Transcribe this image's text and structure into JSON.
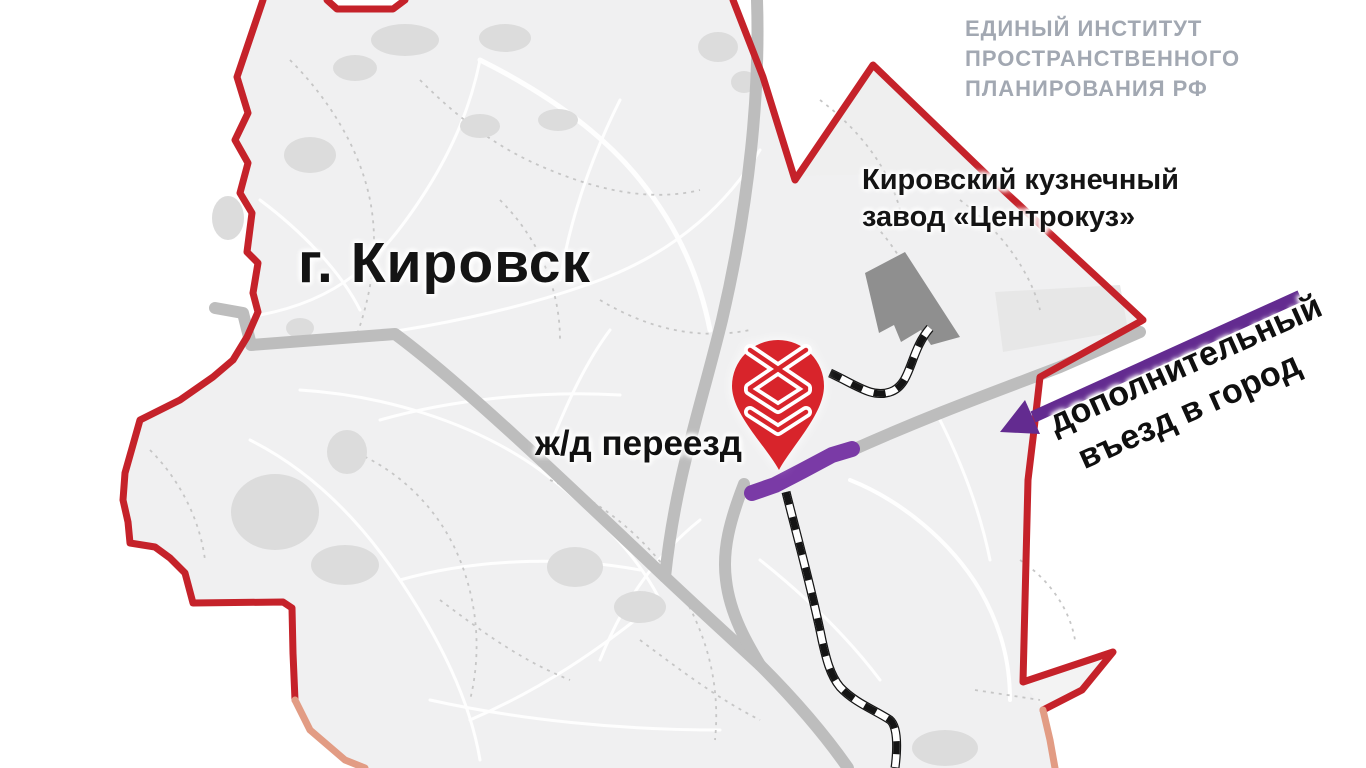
{
  "branding": {
    "institute_line1": "ЕДИНЫЙ ИНСТИТУТ",
    "institute_line2": "ПРОСТРАНСТВЕННОГО",
    "institute_line3": "ПЛАНИРОВАНИЯ РФ"
  },
  "labels": {
    "city_title": "г. Кировск",
    "factory_line1": "Кировский кузнечный",
    "factory_line2": "завод «Центрокуз»",
    "railway_crossing": "ж/д переезд",
    "entrance_line1": "дополнительный",
    "entrance_line2": "въезд в город"
  },
  "icons": {
    "pin": "railway-crossing-pin",
    "arrow": "entrance-direction-arrow"
  },
  "colors": {
    "boundary_red": "#c5222a",
    "boundary_fade": "#e29c84",
    "pin_red": "#d8242b",
    "road_gray": "#bdbdbd",
    "purple_road": "#7a3aa6",
    "purple_arrow": "#632b90",
    "factory_gray": "#8f8f8f",
    "logo_gray": "#a2a8b2",
    "railway_black": "#151515",
    "city_fill": "#f0f0f1",
    "blob_gray": "#dcdcdc"
  }
}
